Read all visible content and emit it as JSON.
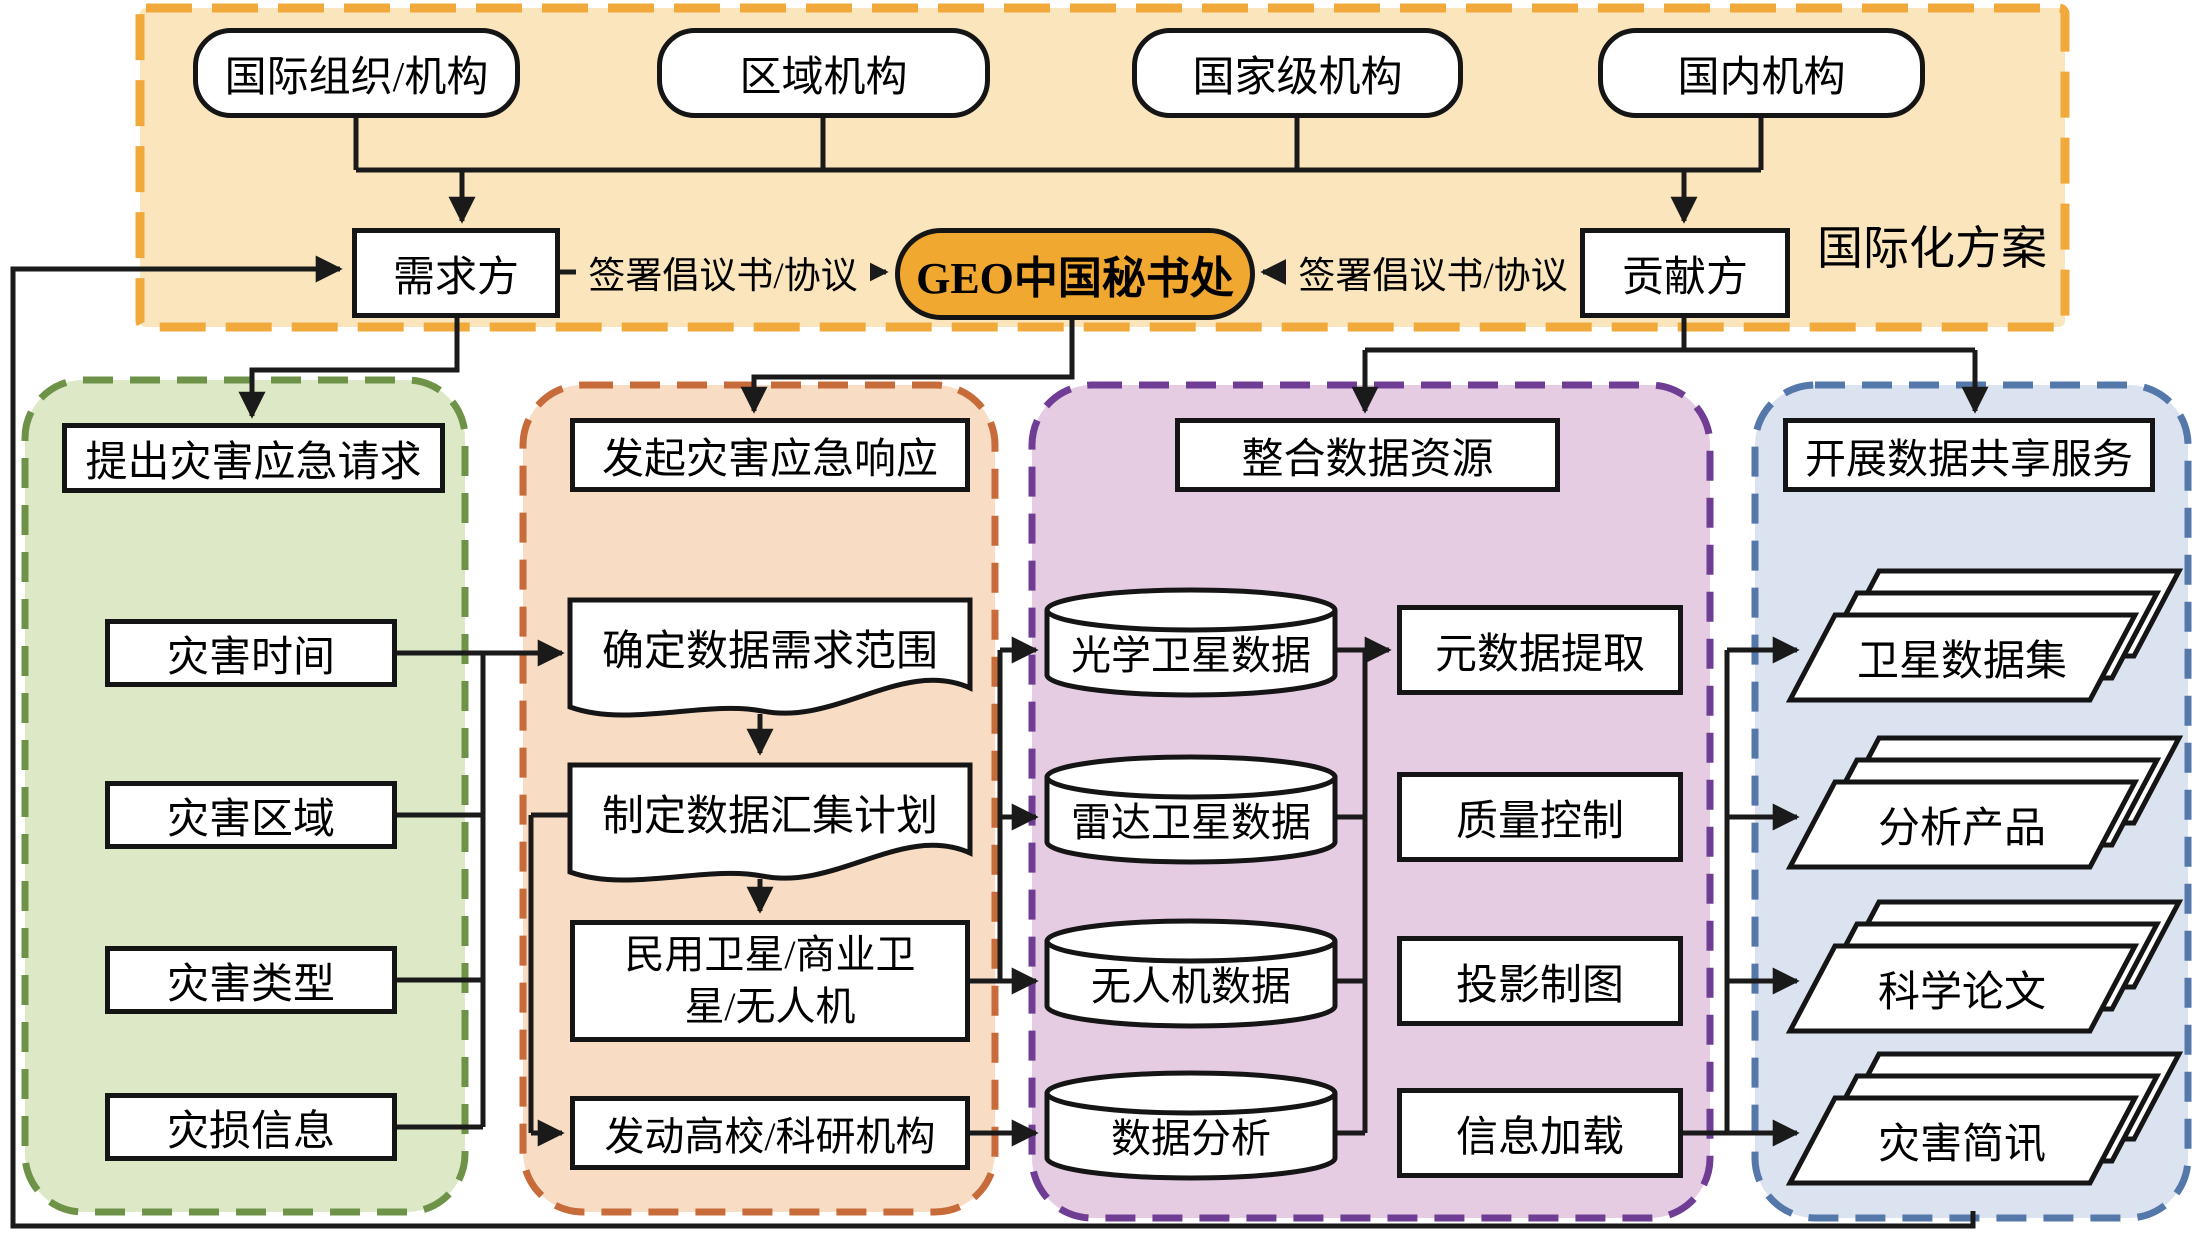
{
  "top": {
    "panel_label": "国际化方案",
    "orgs": [
      "国际组织/机构",
      "区域机构",
      "国家级机构",
      "国内机构"
    ],
    "demand_side": "需求方",
    "secretariat": "GEO中国秘书处",
    "contributor_side": "贡献方",
    "sign_label_left": "签署倡议书/协议",
    "sign_label_right": "签署倡议书/协议"
  },
  "request_column": {
    "header": "提出灾害应急请求",
    "items": [
      "灾害时间",
      "灾害区域",
      "灾害类型",
      "灾损信息"
    ]
  },
  "response_column": {
    "header": "发起灾害应急响应",
    "steps": [
      "确定数据需求范围",
      "制定数据汇集计划",
      "民用卫星/商业卫星/无人机",
      "发动高校/科研机构"
    ]
  },
  "integration_column": {
    "header": "整合数据资源",
    "data_stores": [
      "光学卫星数据",
      "雷达卫星数据",
      "无人机数据",
      "数据分析"
    ],
    "processes": [
      "元数据提取",
      "质量控制",
      "投影制图",
      "信息加载"
    ]
  },
  "sharing_column": {
    "header": "开展数据共享服务",
    "outputs": [
      "卫星数据集",
      "分析产品",
      "科学论文",
      "灾害简讯"
    ]
  },
  "colors": {
    "line": "#1a1a1a",
    "top_panel_fill": "#FAE5BC",
    "top_panel_border": "#F2A93B",
    "geo_fill": "#F0A831",
    "green_fill": "#DCE8C6",
    "green_border": "#6E9248",
    "orange_fill": "#F8DCC4",
    "orange_border": "#C66B39",
    "purple_fill": "#E6CCE3",
    "purple_border": "#6F3E94",
    "blue_fill": "#DCE3F0",
    "blue_border": "#5578AB"
  }
}
